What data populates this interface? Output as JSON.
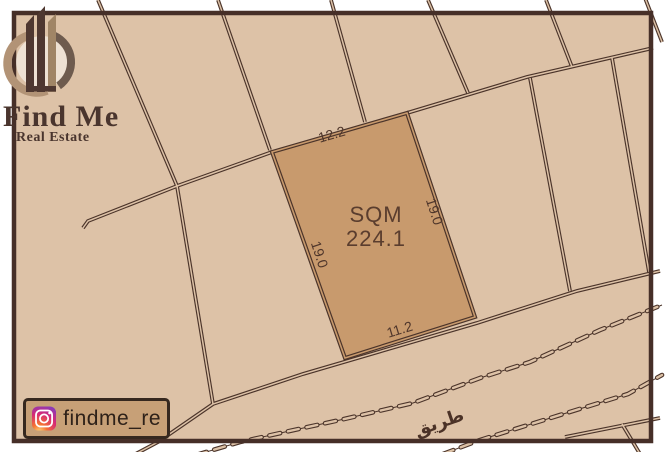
{
  "brand": {
    "name": "Find Me",
    "tagline": "Real Estate",
    "logo_icon": "buildings-swoosh-logo"
  },
  "plot": {
    "area_label": "SQM",
    "area_value": "224.1",
    "dim_top": "12.2",
    "dim_right": "19.0",
    "dim_bottom": "11.2",
    "dim_left": "19.0"
  },
  "road": {
    "label": "طريق"
  },
  "social": {
    "platform_icon": "instagram-icon",
    "handle": "findme_re"
  },
  "colors": {
    "map_bg": "#ddc2a7",
    "plot_fill": "#c89a6d",
    "line": "#4b342a",
    "frame": "#462f28",
    "label_text": "#4f362b",
    "logo_tan": "#b29376",
    "logo_dark": "#4e3730",
    "badge_bg": "#c7a077"
  }
}
